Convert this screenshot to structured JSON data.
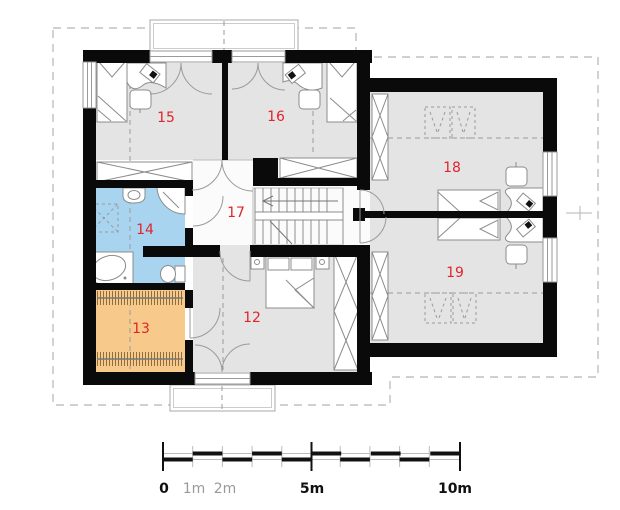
{
  "rooms": {
    "r12": "12",
    "r13": "13",
    "r14": "14",
    "r15": "15",
    "r16": "16",
    "r17": "17",
    "r18": "18",
    "r19": "19"
  },
  "room_types": {
    "r12": "bedroom",
    "r13": "wardrobe",
    "r14": "bathroom",
    "r15": "bedroom",
    "r16": "bedroom",
    "r17": "hall-stairs",
    "r18": "bedroom",
    "r19": "bedroom"
  },
  "colors": {
    "bathroom_fill": "#a9d4ef",
    "wardrobe_fill": "#f7ca8c",
    "floor_fill": "#e4e4e4",
    "hall_fill": "#fbfbfb",
    "wall": "#0a0a0a",
    "room_number": "#e0252b"
  },
  "scale_bar": {
    "l0": "0",
    "l1": "1m",
    "l2": "2m",
    "l5": "5m",
    "l10": "10m"
  }
}
